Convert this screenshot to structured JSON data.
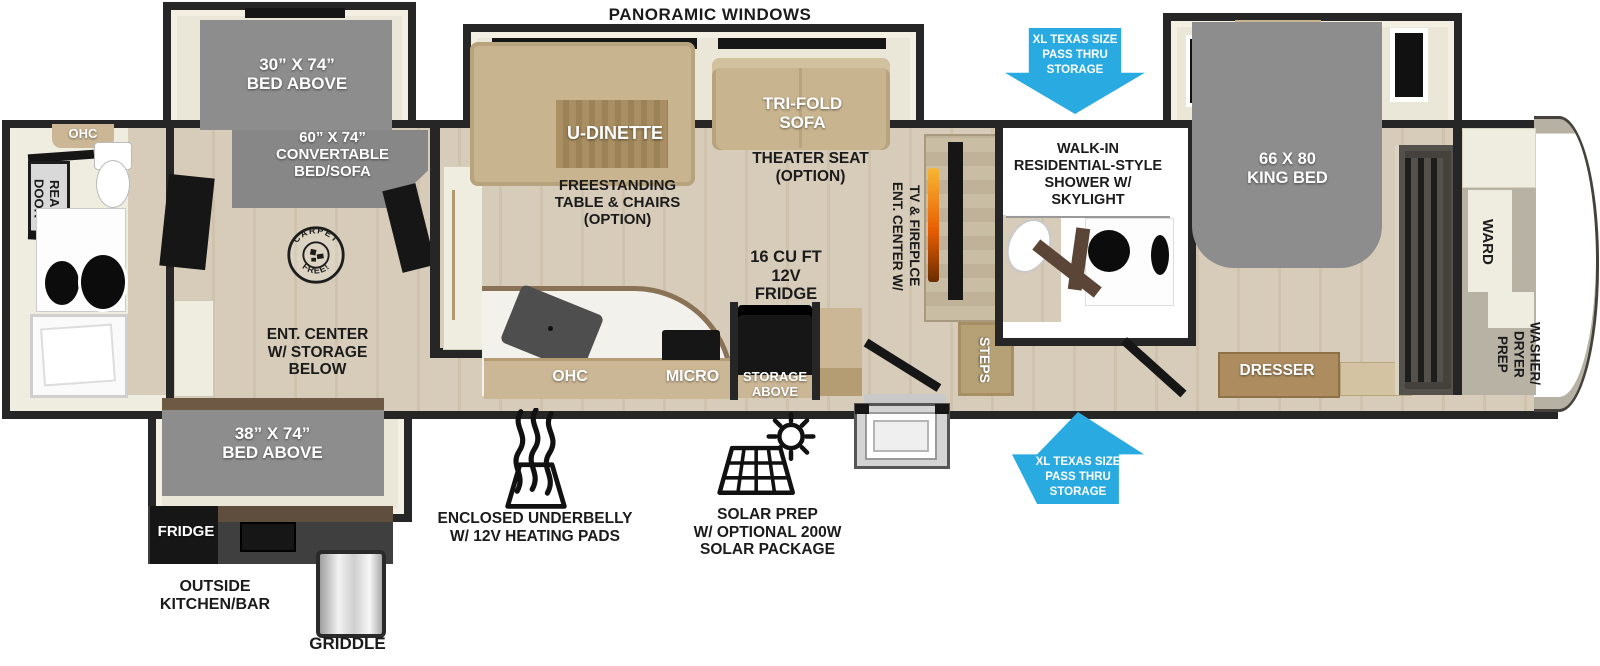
{
  "colors": {
    "wall": "#262626",
    "floor_wood": "#d7ccb9",
    "slide_floor": "#eae6d8",
    "bed_gray": "#8d8d8d",
    "furniture_tan": "#c8b48e",
    "table_wood": "#a98f63",
    "arrow_blue": "#29abe2",
    "appliance_black": "#161616"
  },
  "icons": {
    "pass_thru_top": "arrow-down-icon",
    "pass_thru_bottom": "arrow-up-icon",
    "underbelly": "heat-waves-icon",
    "solar": "solar-panel-sun-icon",
    "carpet_free": "carpet-free-stamp"
  },
  "labels": {
    "panoramic_windows": "PANORAMIC WINDOWS",
    "bunk_bed": "30” X 74”\nBED ABOVE",
    "convertible_bed": "60” X 74”\nCONVERTABLE\nBED/SOFA",
    "ohc_rear": "OHC",
    "rear_door": "REAR\nDOOR",
    "carpet_top": "CARPET",
    "carpet_bottom": "FREE!",
    "ent_center_storage": "ENT. CENTER\nW/ STORAGE\nBELOW",
    "bed_38": "38” X 74”\nBED ABOVE",
    "fridge_outside": "FRIDGE",
    "outside_kitchen": "OUTSIDE\nKITCHEN/BAR",
    "griddle": "GRIDDLE",
    "u_dinette": "U-DINETTE",
    "freestanding_option": "FREESTANDING\nTABLE & CHAIRS\n(OPTION)",
    "tri_fold_sofa": "TRI-FOLD\nSOFA",
    "theater_seat_option": "THEATER SEAT\n(OPTION)",
    "ent_center_tv": "ENT. CENTER W/\nTV & FIREPLCE",
    "fridge_12v": "16 CU FT\n12V\nFRIDGE",
    "ohc_kitchen": "OHC",
    "micro": "MICRO",
    "storage_above": "STORAGE\nABOVE",
    "shower": "WALK-IN\nRESIDENTIAL-STYLE\nSHOWER W/\nSKYLIGHT",
    "steps": "STEPS",
    "king_bed": "66 X 80\nKING BED",
    "dresser": "DRESSER",
    "ward": "WARD",
    "washer_dryer_prep": "WASHER/\nDRYER\nPREP",
    "pass_thru_top": "XL TEXAS SIZE\nPASS THRU\nSTORAGE",
    "pass_thru_bottom": "XL TEXAS SIZE\nPASS THRU\nSTORAGE",
    "underbelly": "ENCLOSED UNDERBELLY\nW/ 12V HEATING PADS",
    "solar": "SOLAR PREP\nW/ OPTIONAL 200W\nSOLAR PACKAGE"
  }
}
